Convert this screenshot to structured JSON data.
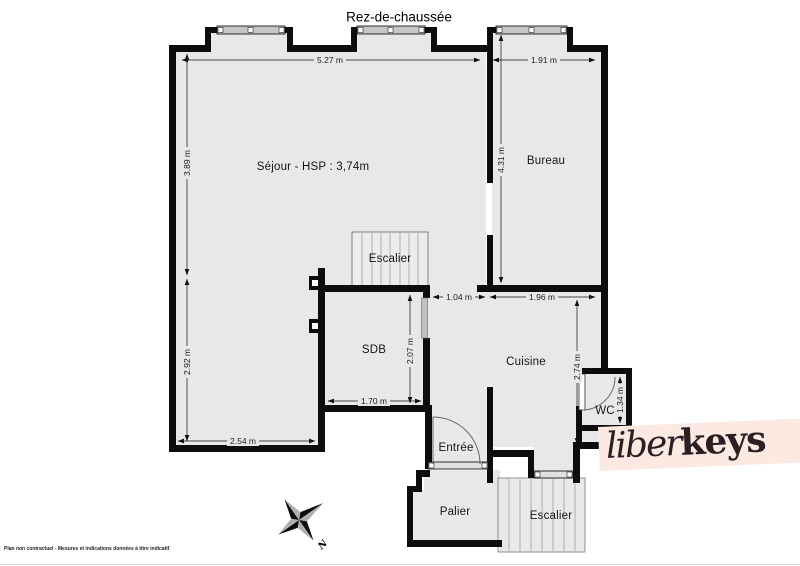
{
  "title": "Rez-de-chaussée",
  "rooms": {
    "sejour": "Séjour - HSP : 3,74m",
    "bureau": "Bureau",
    "escalier_haut": "Escalier",
    "sdb": "SDB",
    "cuisine": "Cuisine",
    "wc": "WC",
    "entree": "Entrée",
    "palier": "Palier",
    "escalier_bas": "Escalier"
  },
  "dimensions": {
    "sejour_largeur": "5.27 m",
    "bureau_largeur": "1.91 m",
    "sejour_hauteur_haut": "3.89 m",
    "sejour_hauteur_bas": "2.92 m",
    "bureau_hauteur": "4.31 m",
    "passage": "1.04 m",
    "cuisine_largeur": "1.96 m",
    "sdb_hauteur": "2.07 m",
    "sdb_largeur": "1.70 m",
    "cuisine_hauteur": "2.74 m",
    "sejour_bas_largeur": "2.54 m",
    "wc_hauteur": "1.34 m"
  },
  "compass": {
    "north": "N"
  },
  "logo": {
    "part1": "liber",
    "part2": "keys"
  },
  "footer": {
    "disclaimer": "Plan non contractuel - Mesures et indications données à titre indicatif"
  },
  "colors": {
    "floor": "#e8e8e8",
    "wall": "#0d0d0d",
    "logo_band": "#fbe9e2",
    "logo_text": "#2a2023"
  }
}
